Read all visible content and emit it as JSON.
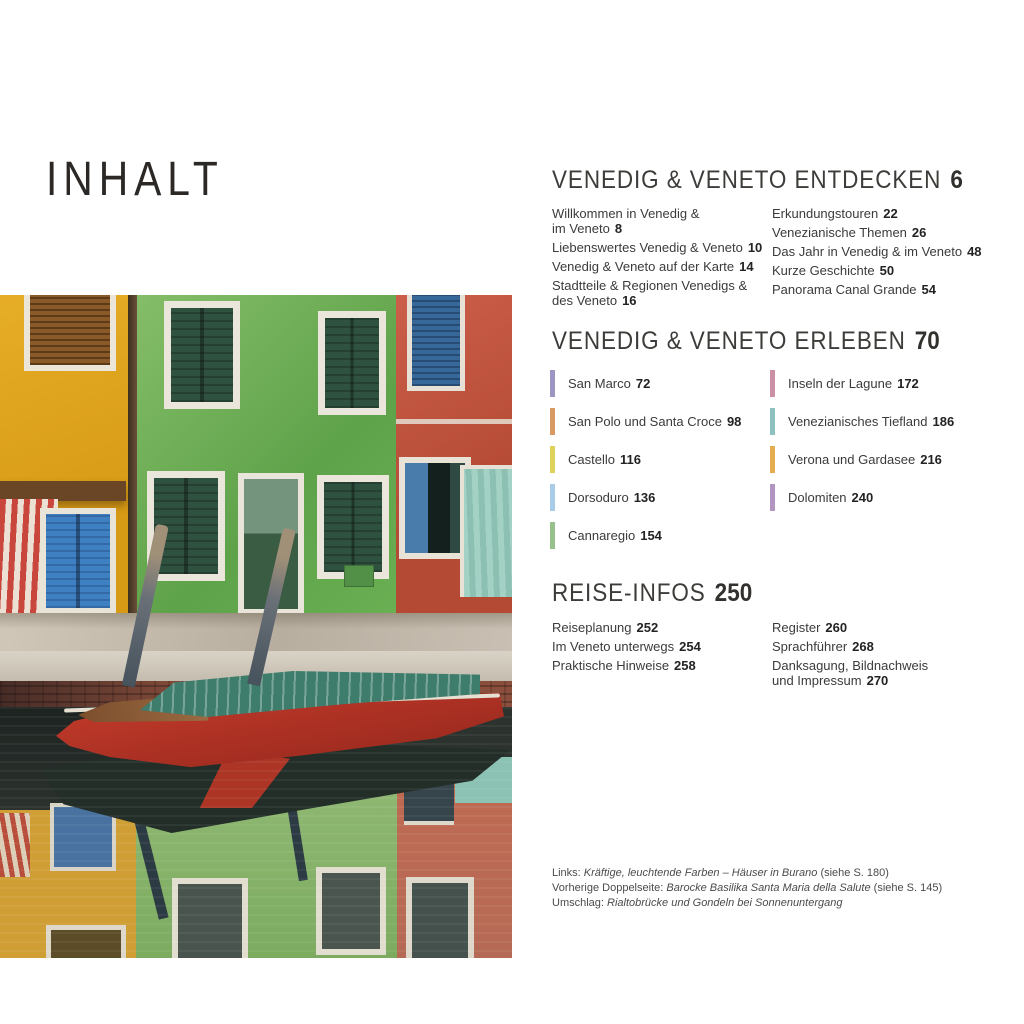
{
  "page_title": "INHALT",
  "sections": {
    "entdecken": {
      "heading": "VENEDIG & VENETO ENTDECKEN",
      "page": "6",
      "left": [
        {
          "label": "Willkommen in Venedig &\nim Veneto",
          "page": "8"
        },
        {
          "label": "Liebenswertes Venedig & Veneto",
          "page": "10"
        },
        {
          "label": "Venedig & Veneto auf der Karte",
          "page": "14"
        },
        {
          "label": "Stadtteile & Regionen Venedigs &\ndes Veneto",
          "page": "16"
        }
      ],
      "right": [
        {
          "label": "Erkundungstouren",
          "page": "22"
        },
        {
          "label": "Venezianische Themen",
          "page": "26"
        },
        {
          "label": "Das Jahr in Venedig & im Veneto",
          "page": "48"
        },
        {
          "label": "Kurze Geschichte",
          "page": "50"
        },
        {
          "label": "Panorama Canal Grande",
          "page": "54"
        }
      ]
    },
    "erleben": {
      "heading": "VENEDIG & VENETO ERLEBEN",
      "page": "70",
      "left": [
        {
          "label": "San Marco",
          "page": "72",
          "color": "#9e96c2"
        },
        {
          "label": "San Polo und Santa Croce",
          "page": "98",
          "color": "#d69a62"
        },
        {
          "label": "Castello",
          "page": "116",
          "color": "#ddd35c"
        },
        {
          "label": "Dorsoduro",
          "page": "136",
          "color": "#a9cde9"
        },
        {
          "label": "Cannaregio",
          "page": "154",
          "color": "#97c08c"
        }
      ],
      "right": [
        {
          "label": "Inseln der Lagune",
          "page": "172",
          "color": "#cb90a6"
        },
        {
          "label": "Venezianisches Tiefland",
          "page": "186",
          "color": "#8fc1c1"
        },
        {
          "label": "Verona und Gardasee",
          "page": "216",
          "color": "#e3ad50"
        },
        {
          "label": "Dolomiten",
          "page": "240",
          "color": "#b295c1"
        }
      ]
    },
    "reiseinfos": {
      "heading": "REISE-INFOS",
      "page": "250",
      "left": [
        {
          "label": "Reiseplanung",
          "page": "252"
        },
        {
          "label": "Im Veneto unterwegs",
          "page": "254"
        },
        {
          "label": "Praktische Hinweise",
          "page": "258"
        }
      ],
      "right": [
        {
          "label": "Register",
          "page": "260"
        },
        {
          "label": "Sprachführer",
          "page": "268"
        },
        {
          "label": "Danksagung, Bildnachweis\nund Impressum",
          "page": "270"
        }
      ]
    }
  },
  "captions": [
    {
      "prefix": "Links: ",
      "italic": "Kräftige, leuchtende Farben – Häuser in Burano",
      "suffix": " (siehe S. 180)"
    },
    {
      "prefix": "Vorherige Doppelseite: ",
      "italic": "Barocke Basilika Santa Maria della Salute",
      "suffix": " (siehe S. 145)"
    },
    {
      "prefix": "Umschlag: ",
      "italic": "Rialtobrücke und Gondeln bei Sonnenuntergang",
      "suffix": ""
    }
  ]
}
